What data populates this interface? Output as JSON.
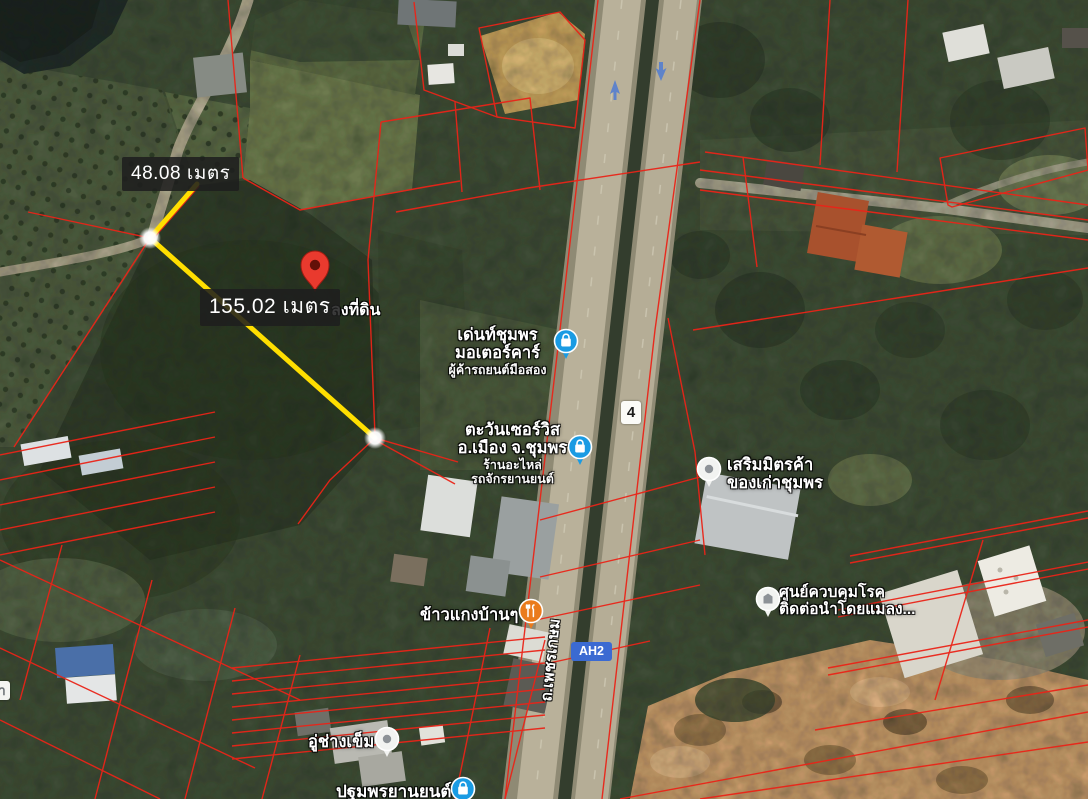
{
  "map": {
    "measurement_labels": {
      "segment_a": "48.08 เมตร",
      "segment_b": "155.02 เมตร"
    },
    "pin": {
      "label": "ลงที่ดิน"
    },
    "places": [
      {
        "line1": "เด่นท์ชุมพร",
        "line2": "มอเตอร์คาร์",
        "sub1": "ผู้ค้ารถยนต์มือสอง",
        "icon": "shopping-bag-icon"
      },
      {
        "line1": "ตะวันเซอร์วิส",
        "line2": "อ.เมือง จ.ชุมพร",
        "sub1": "ร้านอะไหล่",
        "sub2": "รถจักรยานยนต์",
        "icon": "shopping-bag-icon"
      },
      {
        "line1": "เสริมมิตรค้า",
        "line2": "ของเก่าชุมพร",
        "icon": "place-icon"
      },
      {
        "line1": "ศูนย์ควบคุมโรค",
        "line2": "ติดต่อนำโดยแมลง...",
        "icon": "building-icon"
      },
      {
        "line1": "ข้าวแกงบ้านๆ",
        "icon": "restaurant-icon"
      },
      {
        "line1": "อู่ช่างเข็ม",
        "icon": "place-icon"
      },
      {
        "line1": "ปฐมพรยานยนต์",
        "icon": "shopping-bag-icon"
      }
    ],
    "road": {
      "route_shield": "4",
      "asian_highway": "AH2",
      "name": "ถ.เพชรเกษม"
    },
    "edge_fragment": "า",
    "colors": {
      "parcel_line": "#e8271b",
      "measure_line": "#ffde00",
      "measure_label_bg": "#1e1e1e",
      "pin_red": "#e93a2e",
      "shop_icon_blue": "#1a9be3",
      "restaurant_icon_orange": "#ea7b1c",
      "route_shield_bg": "#fbfbf8",
      "asian_highway_bg": "#3b6ad2"
    }
  }
}
